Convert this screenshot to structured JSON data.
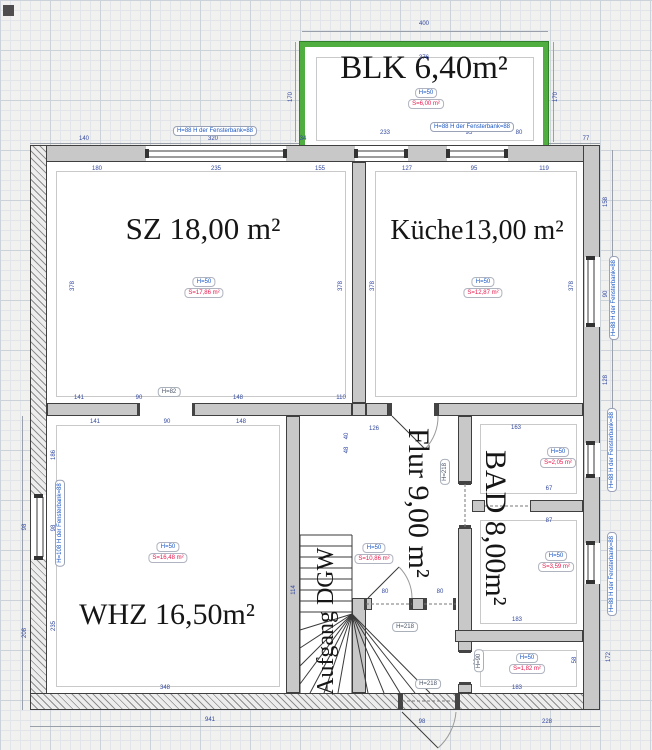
{
  "room_names": {
    "blk": "BLK 6,40m²",
    "sz": "SZ 18,00 m²",
    "kueche": "Küche13,00 m²",
    "whz": "WHZ 16,50m²",
    "flur": "Flur 9,00 m²",
    "bad": "BAD 8,00m²",
    "stairs": "Aufgang DGW"
  },
  "stamps": {
    "blk": {
      "h": "H=50",
      "s": "S=6,00 m²"
    },
    "sz": {
      "h": "H=50",
      "s": "S=17,86 m²"
    },
    "kueche": {
      "h": "H=50",
      "s": "S=12,87 m²"
    },
    "whz": {
      "h": "H=50",
      "s": "S=16,48 m²"
    },
    "flur": {
      "h": "H=50",
      "s": "S=10,86 m²"
    },
    "bad_upper": {
      "h": "H=50",
      "s": "S=2,05 m²"
    },
    "bad_lower": {
      "h": "H=50",
      "s": "S=3,59 m²"
    },
    "store": {
      "h": "H=50",
      "s": "S=1,82 m²"
    }
  },
  "window_labels": {
    "top_sz": "H=88  H der Fensterbank=88",
    "top_kueche": "H=88  H der Fensterbank=88",
    "right_kueche": "H=88  H der Fensterbank=88",
    "right_bad_upper": "H=88  H der Fensterbank=88",
    "right_bad_lower": "H=88  H der Fensterbank=88",
    "left_whz": "H=108  H der Fensterbank=88"
  },
  "door_labels": {
    "sz_opening": "H=82",
    "flur_door": "H=218",
    "entrance_door": "H=218",
    "bad_door": "H=218",
    "store_door": "H=90"
  },
  "dims": {
    "balcony": [
      "400",
      "170",
      "170",
      "376",
      "233",
      "95",
      "80"
    ],
    "top": [
      "140",
      "320",
      "34",
      "77"
    ],
    "sz": [
      "180",
      "235",
      "155",
      "378",
      "378"
    ],
    "kueche": [
      "127",
      "95",
      "119",
      "378",
      "378"
    ],
    "right_outer": [
      "158",
      "90",
      "128"
    ],
    "mid_upper": [
      "141",
      "90",
      "148",
      "110"
    ],
    "mid_lower": [
      "141",
      "90",
      "148"
    ],
    "left_outer": [
      "186",
      "98",
      "98",
      "235",
      "208"
    ],
    "whz": [
      "348"
    ],
    "flur": [
      "126",
      "40",
      "48",
      "114"
    ],
    "bad": [
      "163",
      "67",
      "87"
    ],
    "store": [
      "183",
      "66",
      "58",
      "183"
    ],
    "bottom": [
      "941",
      "98",
      "228",
      "172"
    ],
    "doors": [
      "80",
      "80"
    ]
  },
  "colors": {
    "balcony_green": "#50ad40",
    "wall_gray": "#c8c8c8",
    "stamp_blue": "#1a56c4",
    "stamp_red": "#e8174c",
    "dim_blue": "#31479e"
  }
}
